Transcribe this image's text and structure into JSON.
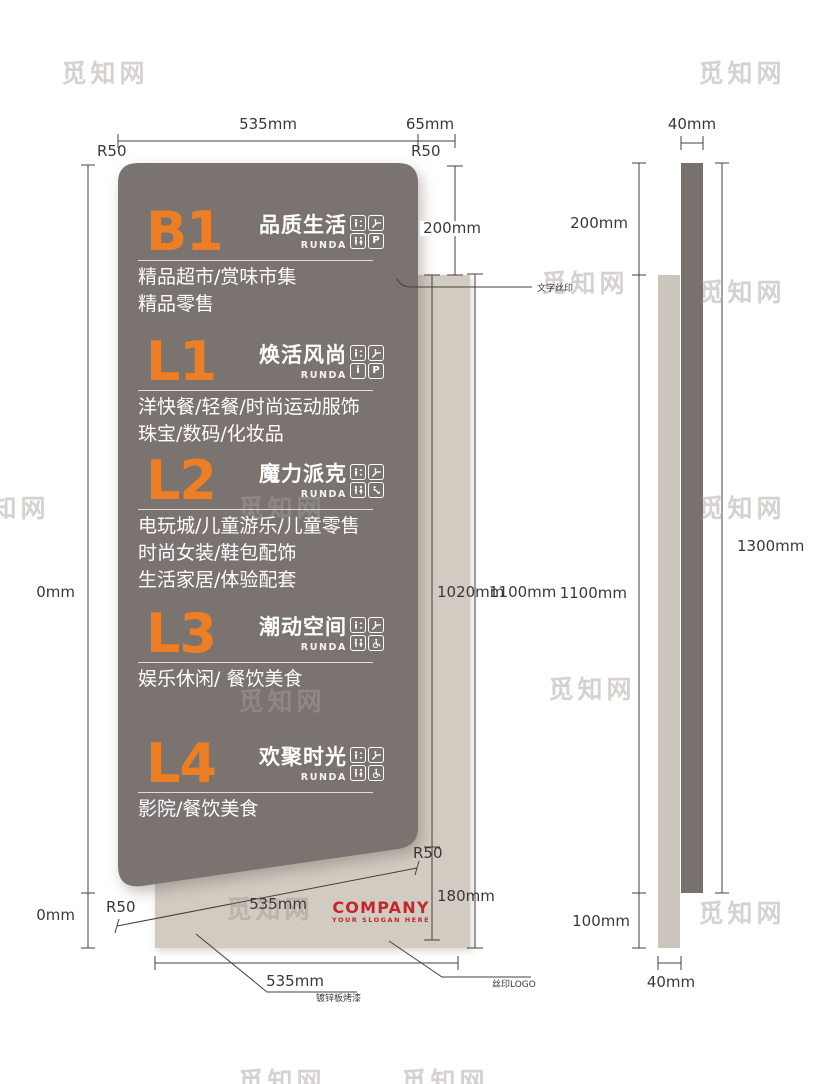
{
  "watermark_text": "觅知网",
  "panel": {
    "sections": [
      {
        "level": "B1",
        "title": "品质生活",
        "brand": "RUNDA",
        "icons": [
          "elevator",
          "escalator",
          "restroom",
          "parking"
        ],
        "desc": [
          "精品超市/赏味市集",
          "精品零售"
        ]
      },
      {
        "level": "L1",
        "title": "焕活风尚",
        "brand": "RUNDA",
        "icons": [
          "elevator",
          "escalator",
          "info",
          "parking"
        ],
        "desc": [
          "洋快餐/轻餐/时尚运动服饰",
          "珠宝/数码/化妆品"
        ]
      },
      {
        "level": "L2",
        "title": "魔力派克",
        "brand": "RUNDA",
        "icons": [
          "elevator",
          "escalator",
          "restroom",
          "nursing"
        ],
        "desc": [
          "电玩城/儿童游乐/儿童零售",
          "时尚女装/鞋包配饰",
          "生活家居/体验配套"
        ]
      },
      {
        "level": "L3",
        "title": "潮动空间",
        "brand": "RUNDA",
        "icons": [
          "elevator",
          "escalator",
          "restroom",
          "wheelchair"
        ],
        "desc": [
          "娱乐休闲/ 餐饮美食"
        ]
      },
      {
        "level": "L4",
        "title": "欢聚时光",
        "brand": "RUNDA",
        "icons": [
          "elevator",
          "escalator",
          "restroom",
          "wheelchair"
        ],
        "desc": [
          "影院/餐饮美食"
        ]
      }
    ]
  },
  "icon_glyphs": {
    "parking": "P",
    "info": "i"
  },
  "logo": {
    "company": "COMPANY",
    "slogan": "YOUR SLOGAN HERE"
  },
  "dims": {
    "top_width": "535mm",
    "top_offset": "65mm",
    "r50": "R50",
    "gap_200": "200mm",
    "front_panel_h": "1020mm",
    "front_total_h": "1100mm",
    "side_h": "1100mm",
    "bottom_strip": "180mm",
    "slant_width": "535mm",
    "bottom_width": "535mm",
    "cut_0mm": "0mm",
    "side_width": "40mm",
    "side_total": "1300mm",
    "side_bottom_ext": "100mm"
  },
  "callouts": {
    "text_silkprint": "文字丝印",
    "paint": "镀锌板烤漆",
    "logo_silkprint": "丝印LOGO"
  },
  "colors": {
    "panel_dark": "#7a7370",
    "panel_beige": "#d1cbc2",
    "accent_orange": "#ee7e23",
    "logo_red": "#c5262b",
    "line": "#46403a"
  }
}
